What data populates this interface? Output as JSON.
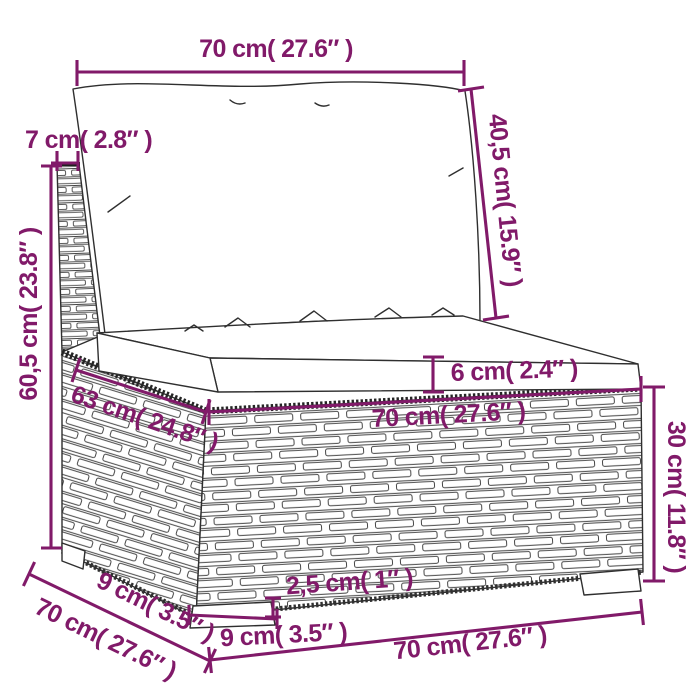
{
  "colors": {
    "dimension": "#811a69",
    "line_art": "#2f2f2f",
    "background": "#ffffff"
  },
  "diagram": {
    "product": "poly rattan sofa middle section with cushions - dimension drawing",
    "labels": {
      "top_width": "70 cm( 27.6″ )",
      "back_post_depth": "7 cm( 2.8″ )",
      "total_height": "60,5 cm( 23.8″ )",
      "back_cushion_height": "40,5 cm( 15.9″ )",
      "seat_cushion_thickness": "6 cm( 2.4″ )",
      "seat_width": "70 cm( 27.6″ )",
      "seat_depth": "63 cm( 24.8″ )",
      "base_height": "30 cm( 11.8″ )",
      "foot_height": "2,5 cm( 1″ )",
      "foot_depth": "9 cm( 3.5″ )",
      "overall_depth": "70 cm( 27.6″ )",
      "foot_width": "9 cm( 3.5″ )",
      "overall_width": "70 cm( 27.6″ )"
    }
  }
}
